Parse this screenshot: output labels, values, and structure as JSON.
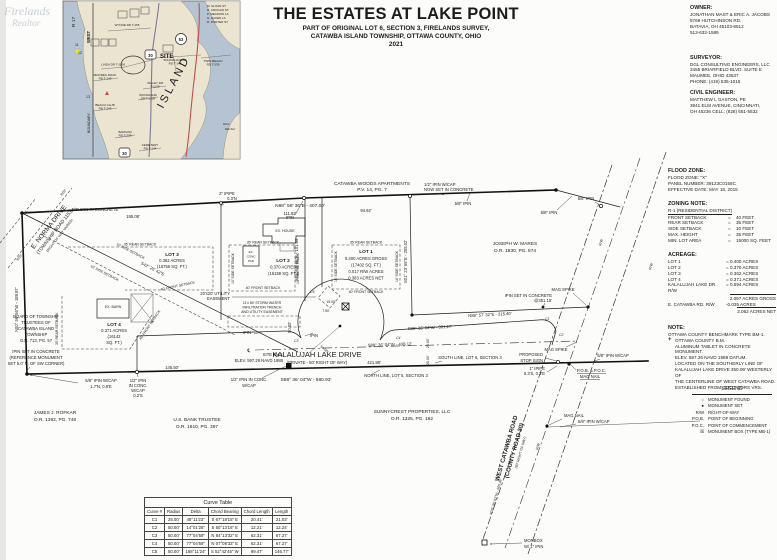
{
  "colors": {
    "paper": "#fcfcfa",
    "ink": "#1c1c1c",
    "water": "#b5c3d2",
    "land": "#eae4d0",
    "route_red": "#c0504d",
    "route_blue": "#7a7a96"
  },
  "title": {
    "line1": "THE ESTATES AT LAKE POINT",
    "line2": "PART OF ORIGINAL LOT 6, SECTION 3, FIRELANDS SURVEY,",
    "line3": "CATAWBA ISLAND TOWNSHIP, OTTAWA COUNTY, OHIO",
    "line4": "2021"
  },
  "owner": {
    "heading": "OWNER:",
    "lines": [
      "JONATHAN MAST & ERIC A. JACOBS",
      "5769 HUTCHINSON RD.",
      "BATAVIA, OH 45103-8512",
      "513-633-1589"
    ]
  },
  "surveyor": {
    "heading": "SURVEYOR:",
    "lines": [
      "DGL CONSULTING ENGINEERS, LLC",
      "3455 BRIARFIELD BLVD. SUITE E",
      "MAUMEE, OHIO 43537",
      "PHONE: (419) 535-1015"
    ]
  },
  "engineer": {
    "heading": "CIVIL ENGINEER:",
    "lines": [
      "MATTHEW L GASTON, PE",
      "3941 ELM AVENUE, CINCINNATI,",
      "OH 45236 CELL: (828) 551-5532"
    ]
  },
  "flood": {
    "heading": "FLOOD ZONE:",
    "lines": [
      "FLOOD ZONE: \"X\"",
      "PANEL NUMBER: 39123C0155C",
      "EFFECTIVE DATE: MAY 18, 2015"
    ]
  },
  "zoning": {
    "heading": "ZONING NOTE:",
    "district": "R-1 (RESIDENTIAL DISTRICT)",
    "eq": "=",
    "rows": [
      {
        "label": "FRONT SETBACK",
        "value": "40 FEET"
      },
      {
        "label": "REAR SETBACK",
        "value": "35 FEET"
      },
      {
        "label": "SIDE SETBACK",
        "value": "10 FEET"
      },
      {
        "label": "MAX. HEIGHT",
        "value": "35 FEET"
      },
      {
        "label": "MIN. LOT AREA",
        "value": "15000 SQ. FEET"
      }
    ]
  },
  "acreage": {
    "heading": "ACREAGE:",
    "rows": [
      {
        "label": "LOT 1",
        "value": "= 0.400 ACRES"
      },
      {
        "label": "LOT 2",
        "value": "= 0.370 ACRES"
      },
      {
        "label": "LOT 3",
        "value": "= 0.362 ACRES"
      },
      {
        "label": "LOT 4",
        "value": "= 0.371 ACRES"
      },
      {
        "label": "KALALUJAH LAKE DR. R/W",
        "value": "= 0.594 ACRES"
      }
    ],
    "gross": "2.097 ACRES GROSS",
    "deduct_label": "E. CATAWBA RD. R/W",
    "deduct_value": "-0.035 ACRES",
    "net": "2.062 ACRES NET"
  },
  "note": {
    "heading": "NOTE:",
    "line1": "OTTAWA COUNTY BENCHMARK TYPE BM-1.",
    "bm_sym": "+",
    "bm_title": "OTTAWA COUNTY B.M.",
    "lines": [
      "ALUMINUM TABLET IN CONCRETE MONUMENT.",
      "ELEV. 597.26 NAVD 1988 DATUM.",
      "LOCATED ON THE SOUTHERLY LINE OF",
      "KALALUJAH LAKE DRIVE 350.09' WESTERLY OF",
      "THE CENTERLINE OF WEST CATAWBA ROAD.",
      "ESTABLISHED FROM ODOT CORS VRS."
    ]
  },
  "legend": {
    "title": "LEGEND",
    "items": [
      {
        "sym": "○",
        "label": "MONUMENT FOUND"
      },
      {
        "sym": "●",
        "label": "MONUMENT SET"
      },
      {
        "sym": "R/W",
        "label": "RIGHT-OF-WAY"
      },
      {
        "sym": "P.O.B.",
        "label": "POINT OF BEGINNING"
      },
      {
        "sym": "P.O.C.",
        "label": "POINT OF COMMENCEMENT"
      },
      {
        "sym": "☒",
        "label": "MONUMENT BOX (TYPE MB-1)"
      }
    ]
  },
  "curve_table": {
    "title": "Curve Table",
    "headers": [
      "Curve #",
      "Radius",
      "Delta",
      "Chord Bearing",
      "Chord Length",
      "Length"
    ],
    "rows": [
      [
        "C1",
        "25.00'",
        "48°11'23\"",
        "S 67°18'15\" E",
        "20.41'",
        "21.03'"
      ],
      [
        "C2",
        "50.00'",
        "14°01'25\"",
        "S 50°13'16\" E",
        "12.21'",
        "12.24'"
      ],
      [
        "C3",
        "50.00'",
        "77°04'59\"",
        "N 84°13'32\" E",
        "62.31'",
        "67.27'"
      ],
      [
        "C4",
        "50.00'",
        "77°04'59\"",
        "N 07°08'33\" E",
        "62.31'",
        "67.27'"
      ],
      [
        "C5",
        "50.00'",
        "168°11'24\"",
        "S 52°42'45\" W",
        "99.47'",
        "146.77'"
      ]
    ]
  },
  "inset": {
    "watermark_1": "Firelands",
    "watermark_2": "Realtor",
    "r17": "R 17",
    "west": "WEST",
    "boundary": "BOUNDARY",
    "island": "ISLAND",
    "site": "SITE",
    "rt30": "30",
    "rt53": "53",
    "harbor_1": "West",
    "harbor_2": "Harbor",
    "n11": "11",
    "n12": "12",
    "n13": "13",
    "list": [
      "M. SLOAN ST",
      "D. CROGAN ST",
      "P. MEADOW LA",
      "G. HAVEN LA",
      "R. PORTER ST"
    ],
    "wynne": "WYNNE RD  T-255",
    "school_1": "SCHOOLHOUSE",
    "school_2": "RD  T-145",
    "twin_1": "TWIN BEACH",
    "twin_2": "RD  T-239",
    "linda": "LINDA DR  T-1108",
    "moores_1": "MOORES DOCK",
    "moores_2": "RD  T-140",
    "valley_1": "VALLEY DR",
    "valley_2": "T-1108",
    "woodland_1": "WOODLAND",
    "woodland_2": "DR  T-1108",
    "beach_1": "BEACH CLUB",
    "beach_2": "RD  T-243",
    "barnum_1": "BARNUM",
    "barnum_2": "RD  T-229",
    "cemetery_1": "CEMETERY",
    "cemetery_2": "RD  T-144"
  },
  "survey": {
    "pin_nw": "5/8\" IPIN IN CONCRETE",
    "dim_195": "195.08'",
    "pipe2_1": "2\" IPIPE",
    "pipe2_2": "0.3'N",
    "ipin": "IPIN",
    "brg_407": "N88° 58' 36\"E - 407.00'",
    "dim_111": "111.92'",
    "dim_94": "94.92'",
    "apts_1": "CATAWBA WOODS APARTMENTS",
    "apts_2": "P.V. 14, PG. 7",
    "cap_set_1": "1/2\" IPIN W/CAP",
    "cap_set_2": "NOW SET IN CONCRETE",
    "pin58": "5/8\" IPIN",
    "mares_1": "JOSEPH W. MARES",
    "mares_2": "O.R. 1830, PG. 874",
    "brg_205": "S01° 23' 56\"E - 205.02'",
    "brg_101": "S01° 58' 56\"E - 101.05'",
    "brg_189": "N00° 56' 56\"W - 189.87'",
    "brg_215": "N88° 57' 32\"E - 215.40'",
    "ipin_351_1": "IPIN SET IN CONCRETE",
    "ipin_351_2": "@351.15'",
    "mag_spike": "MAG SPIKE",
    "brg_391": "S88° 36' 04\"W - 391.27'",
    "brg_438": "S88° 36' 04\"W - 438.12'",
    "dim_421": "421.98'",
    "dim_145": "145.50'",
    "dim_90": "90.00'",
    "dim_15": "15.00'",
    "dim_7": "7.50'",
    "dim_25": "25.00'",
    "dim_50": "50.00'",
    "road_name": "KALALUJAH LAKE DRIVE",
    "road_sub": "(PRIVATE - 50' RIGHT OF WAY)",
    "brg_580": "S88° 36' 04\"W - 580.93'",
    "north_lot5": "NORTH LINE, LOT 5, SECTION 3",
    "south_lot6": "SOUTH LINE, LOT 6, SECTION 3",
    "cap58": "5/8\" IPIN W/CAP",
    "sw_cap_2": "1.7'N, 0.8'E",
    "conc_cap_1": "1/2\" IPIN",
    "conc_cap_2": "IN CONC.",
    "conc_cap_3": "W/CAP",
    "conc_cap_4": "0.2'S",
    "conc_cap5": "1/2\" IPIN IN CONC.",
    "bm_1": "SITE BM 1",
    "bm_2": "ELEV. 597.26 NAVD 1988",
    "stop_1": "PROPOSED",
    "stop_2": "STOP SIGN",
    "pipe1_1": "1\" IPIPE",
    "pipe1_2": "0.3'S, 0.3'E",
    "pob_1": "P.O.B. & P.O.C.",
    "pob_2": "MAG NAIL",
    "mag_nail": "MAG NAIL",
    "sunny_1": "SUNNYCREST PROPERTIES, LLC",
    "sunny_2": "O.R. 1325, PG. 162",
    "usbank_1": "U.S. BANK TRUSTEE",
    "usbank_2": "O.R. 1610, PG. 397",
    "rofkar_1": "JAMES J. ROFKAR",
    "rofkar_2": "O.R. 1392, PG. 748",
    "board": [
      "BOARD OF TOWNSHIP",
      "TRUSTEES OF",
      "CATAWBA ISLAND",
      "TOWNSHIP",
      "O.R. 713, PG. 57"
    ],
    "refmon": [
      "IPIN SET IN CONCRETE",
      "(REFERENCE MONUMENT",
      "SET 5.0' N. OF SW CORNER)"
    ],
    "norma_1": "E. NORMA DRIVE",
    "norma_2": "(TOWNSHIP ROAD 1153)",
    "norma_3": "(RIGHT OF WAY VARIES)",
    "wc_1": "WEST CATAWBA ROAD",
    "wc_2": "(COUNTY ROAD 30)",
    "wc_3": "(60' RIGHT OF WAY)",
    "wc_brg": "N28° 36' 02\"W - 569.46'",
    "monbox_1": "MONBOX",
    "monbox_2": "W/ 1\" IPIN",
    "rw": "R/W",
    "cl": "℄",
    "c1": "C1",
    "c2": "C2",
    "c3": "C3",
    "c4": "C4",
    "c5": "C5",
    "lot1": [
      "LOT 1",
      "0.400 ACRES GROSS",
      "(17402 SQ. FT.)",
      "0.017 R/W ACRES",
      "0.383 ACRES NET"
    ],
    "lot2": [
      "LOT 2",
      "0.370 ACRES",
      "(16158 SQ. FT.)"
    ],
    "lot3": [
      "LOT 3",
      "0.362 ACRES",
      "(15756 SQ. FT.)"
    ],
    "lot4": [
      "LOT 4",
      "0.371 ACRES",
      "(16142",
      "SQ. FT.)"
    ],
    "rear35": "35' REAR SETBACK",
    "front40": "40' FRONT SETBACK",
    "side10": "10' SIDE SETBACK",
    "ex_house": "EX. HOUSE",
    "ex_barn": "EX. BARN",
    "pad": [
      "EX.",
      "CONC",
      "PAD"
    ],
    "ease_1": "20'x20' UTILITY",
    "ease_2": "EASEMENT",
    "storm_1": "11'x 80' STORM WATER",
    "storm_2": "INFILTRATION TRENCH",
    "storm_3": "AND UTILITY EASEMENT",
    "brg_diag": "S42° 26' 42\"E"
  }
}
